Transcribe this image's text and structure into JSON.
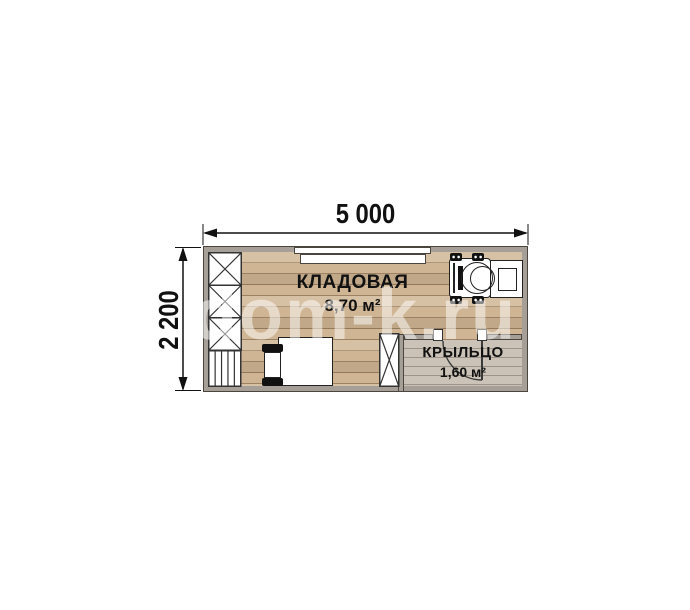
{
  "watermark": {
    "text": "dom-k.ru"
  },
  "dimensions": {
    "width_label": "5 000",
    "height_label": "2 200"
  },
  "rooms": {
    "storage": {
      "name": "КЛАДОВАЯ",
      "area": "8,70 м²"
    },
    "porch": {
      "name": "КРЫЛЬЦО",
      "area": "1,60 м²"
    }
  },
  "colors": {
    "wall_fill": "#a59f97",
    "wall_outline": "#4a453f",
    "floor_wood": "#cfb593",
    "plank_line": "#73583a",
    "porch_floor": "#cbc3b7",
    "label_text": "#111111",
    "watermark": "rgba(255,255,255,0.5)"
  }
}
